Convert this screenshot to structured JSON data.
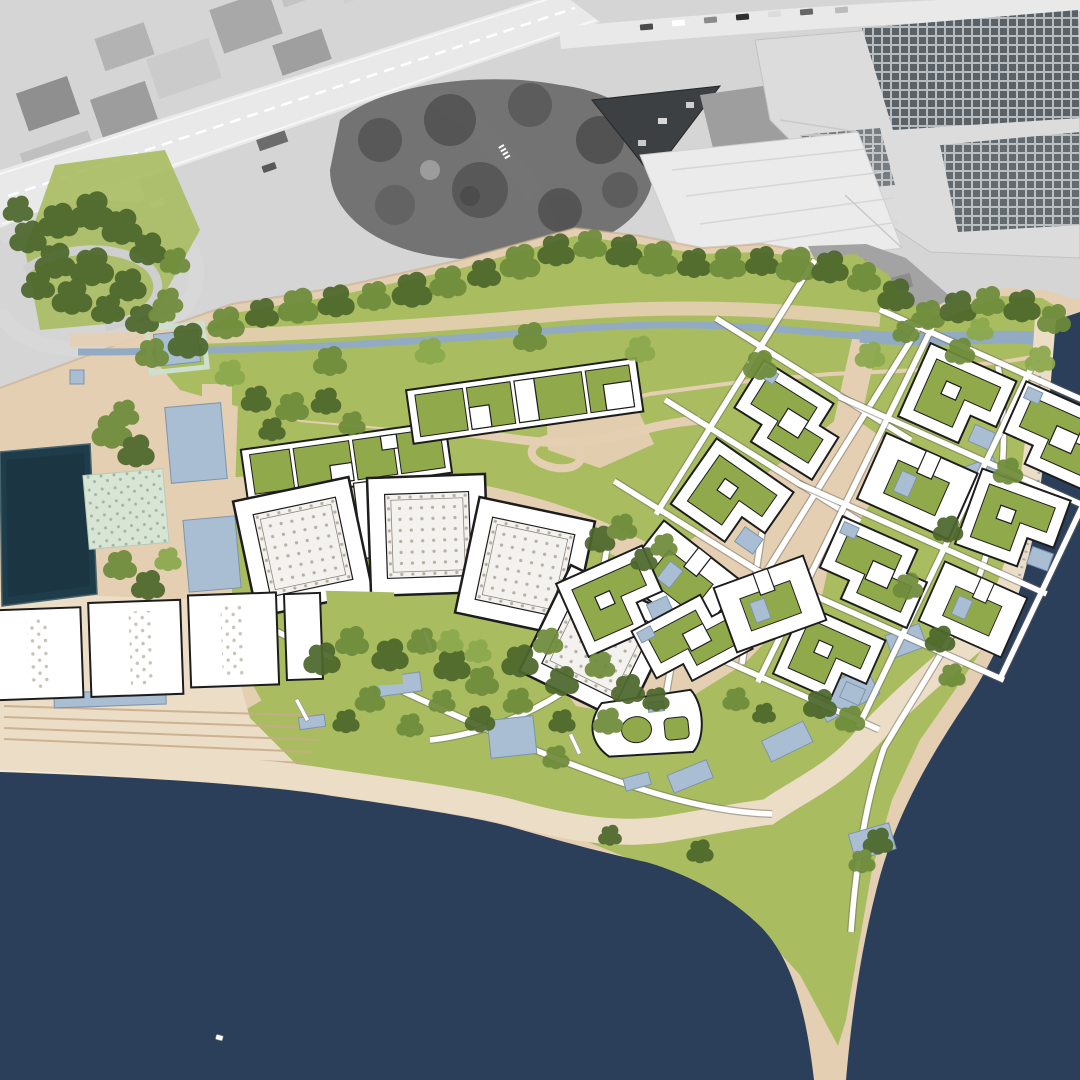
{
  "map": {
    "kind": "architectural-masterplan-aerial-collage",
    "regions": {
      "aerial_photo": "existing-city-grayscale-aerial",
      "highway": "diagonal-motorway",
      "convention_center": "large-solar-roof-complex",
      "park_band": "linear-park-with-stream",
      "marina_basin": "dark-rectangular-water-basin",
      "plaza_pools": "reflecting-pools-plaza",
      "pavilions": "four-rotated-square-halls-dotted-roofs",
      "green_roof_slab": "long-bar-building-green-roof",
      "pier_halls": "three-waterfront-halls-dotted-strips",
      "villa_clusters": "courtyard-villas-with-pools",
      "curved_building": "curved-courtyard-building",
      "promenade": "stepped-waterfront-promenade",
      "sea": "open-water",
      "boat": "small-white-boat"
    }
  },
  "palette": {
    "photo-base": "#d5d5d5",
    "photo-road": "#e9e9e9",
    "photo-block": "#b5b5b5",
    "photo-block-dark": "#8e8e8e",
    "photo-roof-light": "#ebebeb",
    "photo-trees": "#6e6e6e",
    "photo-trees-dark": "#525252",
    "photo-dark-building": "#3c4043",
    "solar-cell": "#5a6167",
    "solar-frame": "#b9bcbe",
    "sand": "#e5cfb2",
    "sand-light": "#eee0cc",
    "sand-path": "#dcc1a1",
    "beach": "#ecddc7",
    "step-line": "#c8ab89",
    "grass": "#a9bd60",
    "roof-green": "#90aa4b",
    "tree-dark": "#4d672c",
    "tree-mid": "#6e8b3b",
    "tree-light": "#8ba84d",
    "sea": "#2b3f5a",
    "basin": "#1f3c4b",
    "pool": "#a9bed3",
    "pool-edge": "#7d93ad",
    "stream": "#92abc3",
    "mint": "#d8e5d5",
    "mint-dot": "#9eb6a4",
    "dot-roof": "#b5afa4",
    "hall-dot": "#c9c2b6",
    "line": "#1d1d1d",
    "white": "#ffffff"
  }
}
